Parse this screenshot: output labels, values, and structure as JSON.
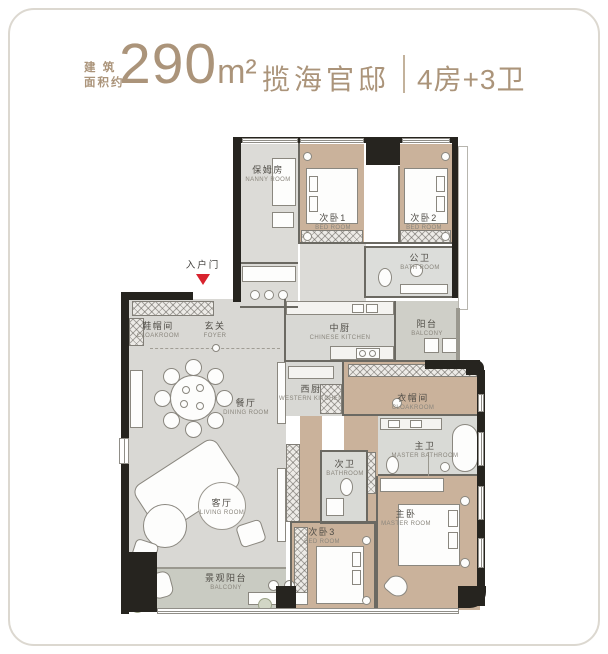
{
  "header": {
    "prefix_line1": "建 筑",
    "prefix_line2": "面积约",
    "area_value": "290",
    "area_unit": "m²",
    "project_name": "揽海官邸",
    "layout_info": "4房+3卫"
  },
  "entrance": {
    "label": "入户门"
  },
  "rooms": [
    {
      "id": "nanny",
      "zh": "保姆房",
      "en": "NANNY ROOM"
    },
    {
      "id": "bedroom1",
      "zh": "次卧1",
      "en": "BED ROOM"
    },
    {
      "id": "bedroom2",
      "zh": "次卧2",
      "en": "BED ROOM"
    },
    {
      "id": "public-bath",
      "zh": "公卫",
      "en": "BATH ROOM"
    },
    {
      "id": "shoe-cloakroom",
      "zh": "鞋帽间",
      "en": "CLOAKROOM"
    },
    {
      "id": "foyer",
      "zh": "玄关",
      "en": "FOYER"
    },
    {
      "id": "chinese-kitchen",
      "zh": "中厨",
      "en": "CHINESE KITCHEN"
    },
    {
      "id": "balcony-upper",
      "zh": "阳台",
      "en": "BALCONY"
    },
    {
      "id": "western-kitchen",
      "zh": "西厨",
      "en": "WESTERN KITCHEN"
    },
    {
      "id": "cloakroom",
      "zh": "衣帽间",
      "en": "CLOAKROOM"
    },
    {
      "id": "dining",
      "zh": "餐厅",
      "en": "DINING ROOM"
    },
    {
      "id": "master-bath",
      "zh": "主卫",
      "en": "MASTER BATHROOM"
    },
    {
      "id": "bath2",
      "zh": "次卫",
      "en": "BATHROOM"
    },
    {
      "id": "living",
      "zh": "客厅",
      "en": "LIVING ROOM"
    },
    {
      "id": "bedroom3",
      "zh": "次卧3",
      "en": "BED ROOM"
    },
    {
      "id": "master",
      "zh": "主卧",
      "en": "MASTER ROOM"
    },
    {
      "id": "view-balcony",
      "zh": "景观阳台",
      "en": "BALCONY"
    }
  ],
  "colors": {
    "accent": "#ab947a",
    "entrance_marker": "#d8232e",
    "wall": "#26241f",
    "floor_wood": "#cab29b",
    "floor_gray": "#d9d8d4",
    "floor_tile": "#d9dad6",
    "floor_balcony": "#c9cbc2"
  }
}
